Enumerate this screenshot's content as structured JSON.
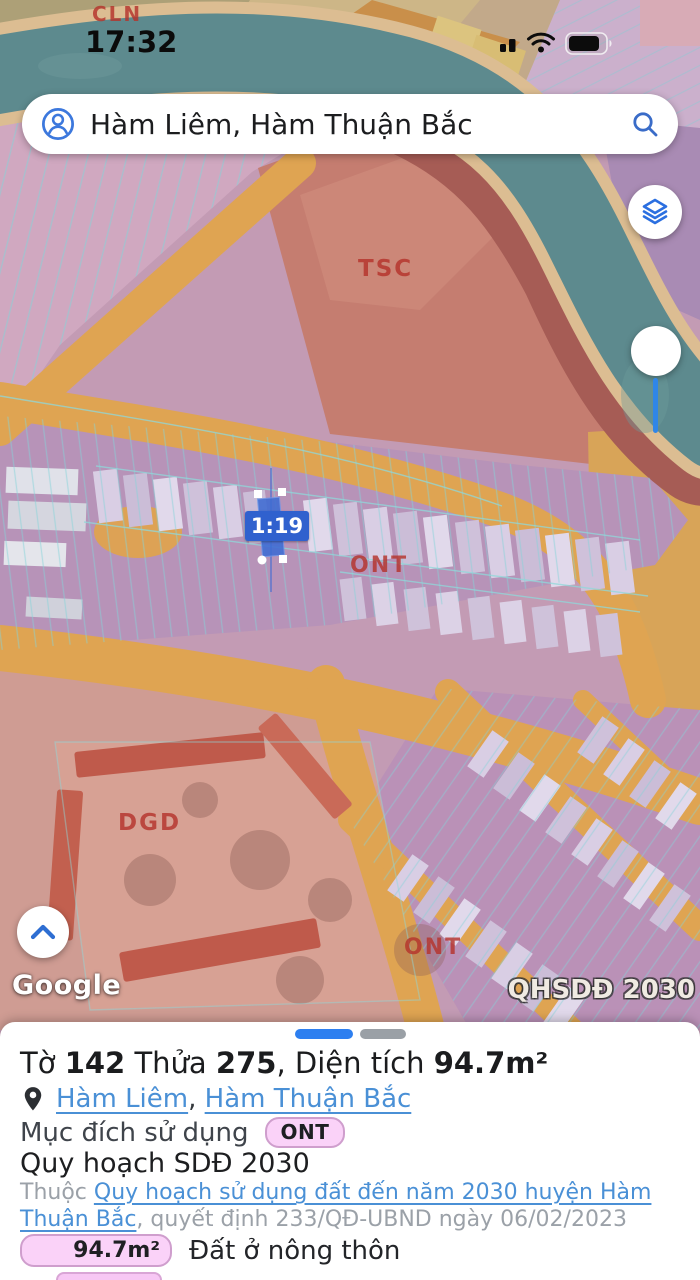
{
  "status_bar": {
    "time": "17:32",
    "icons": [
      "cell-signal",
      "wifi",
      "battery"
    ]
  },
  "search": {
    "query": "Hàm Liêm, Hàm Thuận Bắc"
  },
  "map": {
    "zone_labels": {
      "top": "CLN",
      "tsc": "TSC",
      "mid": "ONT",
      "school": "DGD",
      "bottom": "ONT"
    },
    "selected_parcel_label": "1:19",
    "watermark": "Google",
    "plan_badge": "QHSDĐ 2030"
  },
  "sheet": {
    "title_segments": [
      "Tờ ",
      "142",
      " Thửa ",
      "275",
      ", Diện tích ",
      "94.7m²"
    ],
    "location": {
      "link1": "Hàm Liêm",
      "separator": ", ",
      "link2": "Hàm Thuận Bắc"
    },
    "purpose": {
      "label": "Mục đích sử dụng",
      "badge": "ONT"
    },
    "plan_heading": "Quy hoạch SDĐ 2030",
    "plan_detail": {
      "prefix": "Thuộc ",
      "link": "Quy hoạch sử dụng đất đến năm 2030 huyện Hàm Thuận Bắc",
      "suffix": ", quyết định 233/QĐ-UBND ngày 06/02/2023"
    },
    "area": {
      "value": "94.7m²",
      "label": "Đất ở nông thôn"
    }
  },
  "colors": {
    "accent_blue": "#2b6fe0",
    "link_blue": "#4a90d6",
    "selection_blue": "#3061ce",
    "zone_label_red": "#b5342c",
    "badge_pink_bg": "#fad2f8",
    "badge_pink_border": "#cf9ecd",
    "river_teal": "#5d8a8e",
    "road_orange": "#dfa452",
    "parcel_cyan": "#84d3d8"
  }
}
